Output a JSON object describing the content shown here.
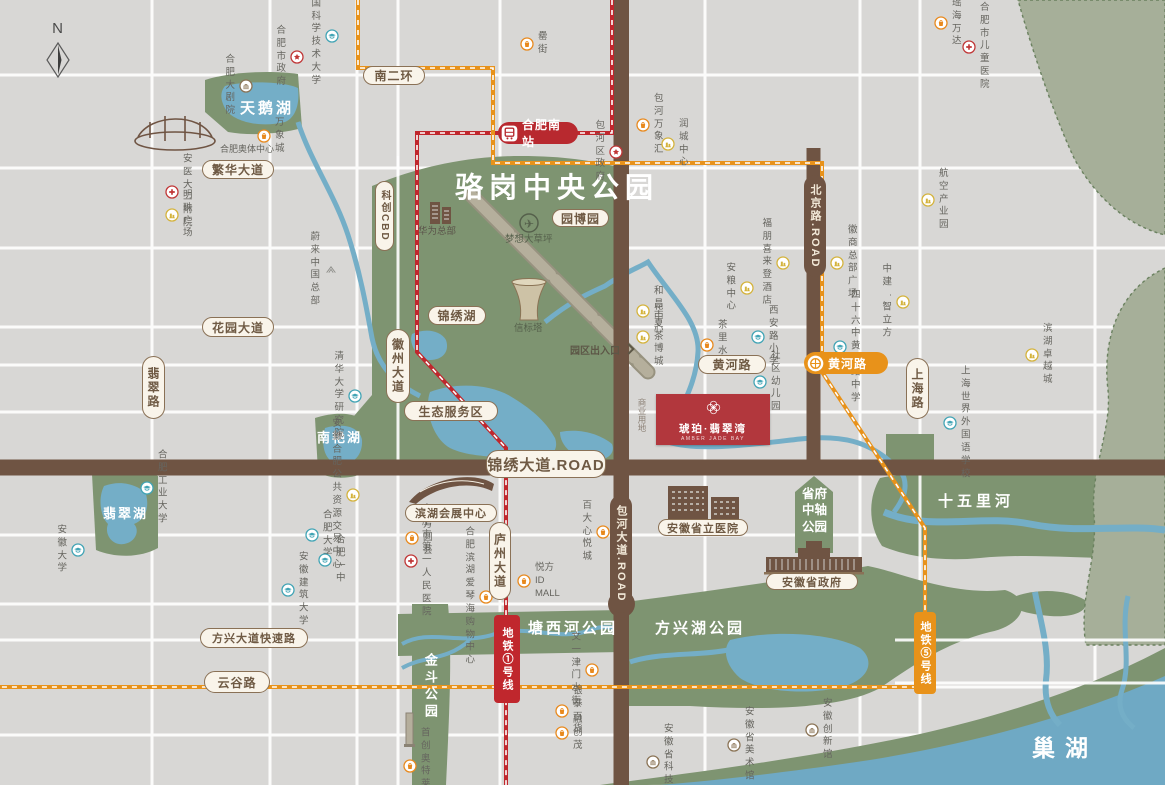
{
  "title": "骆岗中央公园",
  "compass": {
    "label": "N"
  },
  "project": {
    "name": "琥珀·翡翠湾",
    "subtitle": "AMBER JADE BAY"
  },
  "colors": {
    "bg": "#d8d7d5",
    "park": "#7e9471",
    "water": "#74aec7",
    "lake": "#6fa9c4",
    "road_brown": "#6f5443",
    "metro1_red": "#c0272d",
    "metro5_orange": "#e8921a",
    "badge_cream": "#f9f4ea",
    "badge_border": "#8a7156",
    "project_red": "#b2373d"
  },
  "road_badges": [
    {
      "label": "南二环",
      "x": 363,
      "y": 66,
      "w": 62,
      "h": 19,
      "style": "h"
    },
    {
      "label": "繁华大道",
      "x": 202,
      "y": 160,
      "w": 72,
      "h": 19,
      "style": "h"
    },
    {
      "label": "花园大道",
      "x": 202,
      "y": 317,
      "w": 72,
      "h": 20,
      "style": "h"
    },
    {
      "label": "锦绣湖",
      "x": 428,
      "y": 306,
      "w": 58,
      "h": 19,
      "style": "h"
    },
    {
      "label": "园博园",
      "x": 552,
      "y": 209,
      "w": 57,
      "h": 18,
      "style": "h"
    },
    {
      "label": "生态服务区",
      "x": 404,
      "y": 401,
      "w": 94,
      "h": 20,
      "style": "h"
    },
    {
      "label": "黄河路",
      "x": 698,
      "y": 355,
      "w": 68,
      "h": 19,
      "style": "h"
    },
    {
      "label": "方兴大道快速路",
      "x": 200,
      "y": 628,
      "w": 108,
      "h": 20,
      "style": "h",
      "fs": 11
    },
    {
      "label": "云谷路",
      "x": 204,
      "y": 671,
      "w": 66,
      "h": 22,
      "style": "h"
    },
    {
      "label": "滨湖会展中心",
      "x": 405,
      "y": 504,
      "w": 92,
      "h": 18,
      "style": "h",
      "fs": 11
    },
    {
      "label": "安徽省立医院",
      "x": 658,
      "y": 519,
      "w": 90,
      "h": 17,
      "style": "h",
      "fs": 11
    },
    {
      "label": "安徽省政府",
      "x": 766,
      "y": 573,
      "w": 92,
      "h": 17,
      "style": "h",
      "fs": 11
    },
    {
      "label": "锦绣大道.ROAD",
      "x": 486,
      "y": 450,
      "w": 120,
      "h": 28,
      "style": "h",
      "fs": 15
    },
    {
      "label": "翡翠路",
      "x": 142,
      "y": 356,
      "w": 23,
      "h": 63,
      "style": "v"
    },
    {
      "label": "徽州大道",
      "x": 386,
      "y": 329,
      "w": 24,
      "h": 74,
      "style": "v"
    },
    {
      "label": "科创CBD",
      "x": 375,
      "y": 181,
      "w": 19,
      "h": 70,
      "style": "v",
      "fs": 10
    },
    {
      "label": "上海路",
      "x": 906,
      "y": 358,
      "w": 23,
      "h": 61,
      "style": "v"
    },
    {
      "label": "庐州大道",
      "x": 489,
      "y": 522,
      "w": 22,
      "h": 78,
      "style": "v"
    },
    {
      "label": "北京路.ROAD",
      "x": 804,
      "y": 175,
      "w": 22,
      "h": 102,
      "style": "sv"
    },
    {
      "label": "包河大道.ROAD",
      "x": 610,
      "y": 495,
      "w": 22,
      "h": 118,
      "style": "sv"
    }
  ],
  "stations": [
    {
      "label": "合肥南站",
      "x": 498,
      "y": 122,
      "w": 80,
      "h": 22,
      "color": "#b8292f",
      "icon": "train"
    },
    {
      "label": "黄河路",
      "x": 804,
      "y": 352,
      "w": 84,
      "h": 22,
      "color": "#e8921a",
      "icon": "metro"
    }
  ],
  "metro_badges": [
    {
      "label": "地铁①号线",
      "x": 494,
      "y": 615,
      "w": 26,
      "h": 88,
      "color": "#c0272d"
    },
    {
      "label": "地铁⑤号线",
      "x": 914,
      "y": 612,
      "w": 22,
      "h": 82,
      "color": "#e8921a"
    }
  ],
  "pois": [
    {
      "label": "中国科学技术大学",
      "x": 332,
      "y": 36,
      "icon": "school",
      "side": "l"
    },
    {
      "label": "合肥市政府",
      "x": 297,
      "y": 57,
      "icon": "gov",
      "side": "l"
    },
    {
      "label": "合肥大剧院",
      "x": 246,
      "y": 86,
      "icon": "museum",
      "side": "l"
    },
    {
      "label": "万象城",
      "x": 264,
      "y": 136,
      "icon": "mall",
      "side": "r"
    },
    {
      "label": "安医大二附院",
      "x": 172,
      "y": 192,
      "icon": "hosp",
      "side": "r"
    },
    {
      "label": "明珠广场",
      "x": 172,
      "y": 215,
      "icon": "biz",
      "side": "r"
    },
    {
      "label": "罍街",
      "x": 527,
      "y": 44,
      "icon": "mall",
      "side": "r"
    },
    {
      "label": "包河区政府",
      "x": 616,
      "y": 152,
      "icon": "gov",
      "side": "l"
    },
    {
      "label": "包河万象汇",
      "x": 643,
      "y": 125,
      "icon": "mall",
      "side": "r"
    },
    {
      "label": "润城中心",
      "x": 668,
      "y": 144,
      "icon": "biz",
      "side": "r"
    },
    {
      "label": "瑶海万达",
      "x": 941,
      "y": 23,
      "icon": "mall",
      "side": "r"
    },
    {
      "label": "合肥市儿童医院",
      "x": 969,
      "y": 47,
      "icon": "hosp",
      "side": "r"
    },
    {
      "label": "航空产业园",
      "x": 928,
      "y": 200,
      "icon": "biz",
      "side": "r"
    },
    {
      "label": "徽商总部广场",
      "x": 837,
      "y": 263,
      "icon": "biz",
      "side": "r"
    },
    {
      "label": "中建·智立方",
      "x": 903,
      "y": 302,
      "icon": "biz",
      "side": "l"
    },
    {
      "label": "福朋喜来登酒店",
      "x": 783,
      "y": 263,
      "icon": "biz",
      "side": "l"
    },
    {
      "label": "安粮中心",
      "x": 747,
      "y": 288,
      "icon": "biz",
      "side": "l"
    },
    {
      "label": "和昌中心",
      "x": 643,
      "y": 311,
      "icon": "biz",
      "side": "r"
    },
    {
      "label": "华夏茶博城",
      "x": 643,
      "y": 337,
      "icon": "biz",
      "side": "r"
    },
    {
      "label": "茶里水街",
      "x": 707,
      "y": 345,
      "icon": "mall",
      "side": "r"
    },
    {
      "label": "西安路小学",
      "x": 758,
      "y": 337,
      "icon": "school",
      "side": "r"
    },
    {
      "label": "四十六中黄河路中学",
      "x": 840,
      "y": 347,
      "icon": "school",
      "side": "r"
    },
    {
      "label": "社区幼儿园",
      "x": 760,
      "y": 382,
      "icon": "school",
      "side": "r"
    },
    {
      "label": "滨湖卓越城",
      "x": 1032,
      "y": 355,
      "icon": "biz",
      "side": "r"
    },
    {
      "label": "上海世界外国语学校",
      "x": 950,
      "y": 423,
      "icon": "school",
      "side": "r"
    },
    {
      "label": "蔚来中国总部",
      "x": 331,
      "y": 270,
      "icon": "nio",
      "side": "l"
    },
    {
      "label": "清华大学研究院",
      "x": 355,
      "y": 396,
      "icon": "school",
      "side": "l"
    },
    {
      "label": "合肥工业大学",
      "x": 147,
      "y": 488,
      "icon": "school",
      "side": "r"
    },
    {
      "label": "安徽大学",
      "x": 78,
      "y": 550,
      "icon": "school",
      "side": "l"
    },
    {
      "label": "安徽合肥\n公共资源交易中心",
      "x": 353,
      "y": 495,
      "icon": "biz",
      "side": "l"
    },
    {
      "label": "合肥大学",
      "x": 312,
      "y": 535,
      "icon": "school",
      "side": "r"
    },
    {
      "label": "合肥一中",
      "x": 325,
      "y": 560,
      "icon": "school",
      "side": "r"
    },
    {
      "label": "安徽建筑大学",
      "x": 288,
      "y": 590,
      "icon": "school",
      "side": "r"
    },
    {
      "label": "方圆荟",
      "x": 412,
      "y": 538,
      "icon": "mall",
      "side": "r"
    },
    {
      "label": "合肥市\n第一人民医院",
      "x": 411,
      "y": 561,
      "icon": "hosp",
      "side": "r"
    },
    {
      "label": "百大心悦城",
      "x": 603,
      "y": 532,
      "icon": "mall",
      "side": "l"
    },
    {
      "label": "悦方ID MALL",
      "x": 524,
      "y": 581,
      "icon": "mall",
      "side": "r"
    },
    {
      "label": "合肥滨湖\n爱琴海购物中心",
      "x": 486,
      "y": 597,
      "icon": "mall",
      "side": "l"
    },
    {
      "label": "文一津门水街",
      "x": 592,
      "y": 670,
      "icon": "mall",
      "side": "l"
    },
    {
      "label": "银泰百货",
      "x": 562,
      "y": 711,
      "icon": "mall",
      "side": "r"
    },
    {
      "label": "融创茂",
      "x": 562,
      "y": 733,
      "icon": "mall",
      "side": "r"
    },
    {
      "label": "安徽省科技馆",
      "x": 653,
      "y": 762,
      "icon": "museum",
      "side": "r"
    },
    {
      "label": "安徽省美术馆",
      "x": 734,
      "y": 745,
      "icon": "museum",
      "side": "r"
    },
    {
      "label": "安徽创新馆",
      "x": 812,
      "y": 730,
      "icon": "museum",
      "side": "r"
    },
    {
      "label": "首创奥特莱斯",
      "x": 410,
      "y": 766,
      "icon": "mall",
      "side": "r"
    }
  ],
  "labels": [
    {
      "t": "骆岗中央公园",
      "x": 455,
      "y": 170,
      "size": 28,
      "color": "#ffffff",
      "bold": 1,
      "ls": 6
    },
    {
      "t": "天鹅湖",
      "x": 240,
      "y": 99,
      "size": 15,
      "color": "#ffffff",
      "bold": 1,
      "ls": 3
    },
    {
      "t": "南艳湖",
      "x": 317,
      "y": 430,
      "size": 13,
      "color": "#ffffff",
      "bold": 1,
      "ls": 2
    },
    {
      "t": "翡翠湖",
      "x": 103,
      "y": 506,
      "size": 13,
      "color": "#ffffff",
      "bold": 1,
      "ls": 2
    },
    {
      "t": "十五里河",
      "x": 938,
      "y": 492,
      "size": 15,
      "color": "#ffffff",
      "bold": 1,
      "ls": 4
    },
    {
      "t": "塘西河公园",
      "x": 528,
      "y": 619,
      "size": 15,
      "color": "#ffffff",
      "bold": 1,
      "ls": 3
    },
    {
      "t": "方兴湖公园",
      "x": 655,
      "y": 619,
      "size": 15,
      "color": "#ffffff",
      "bold": 1,
      "ls": 3
    },
    {
      "t": "巢湖",
      "x": 1032,
      "y": 734,
      "size": 23,
      "color": "#ffffff",
      "bold": 1,
      "ls": 10
    },
    {
      "t": "金斗公园",
      "x": 421,
      "y": 653,
      "size": 13,
      "color": "#ffffff",
      "bold": 1,
      "ls": 4,
      "v": 1
    },
    {
      "t": "省府\n中轴\n公园",
      "x": 796,
      "y": 486,
      "size": 12.5,
      "color": "#ffffff",
      "bold": 1,
      "w": 37,
      "align": "center"
    },
    {
      "t": "商业用地",
      "x": 636,
      "y": 398,
      "size": 8.5,
      "color": "#8d8277",
      "v": 1
    },
    {
      "t": "华为总部",
      "x": 418,
      "y": 226,
      "size": 9.5,
      "color": "#5b544a"
    },
    {
      "t": "梦想大草坪",
      "x": 505,
      "y": 234,
      "size": 9.5,
      "color": "#55604b"
    },
    {
      "t": "信标塔",
      "x": 514,
      "y": 323,
      "size": 9.5,
      "color": "#55604b"
    },
    {
      "t": "合肥奥体中心",
      "x": 220,
      "y": 144,
      "size": 9,
      "color": "#66655f"
    },
    {
      "t": "园区出入口",
      "x": 570,
      "y": 345,
      "size": 10,
      "color": "#5d5747",
      "bold": 1,
      "chev": 1
    }
  ]
}
